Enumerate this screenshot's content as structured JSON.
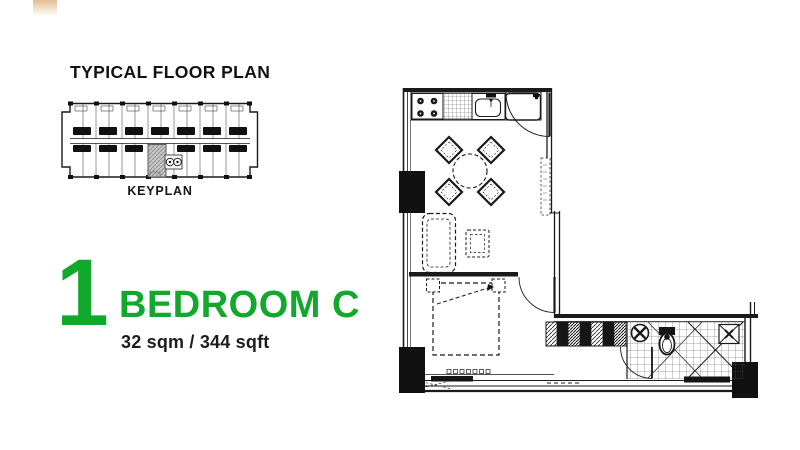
{
  "page": {
    "background": "#ffffff"
  },
  "decor": {
    "corner_square": {
      "top_color": "#e2bd92",
      "bottom_color": "#fdfaf5"
    }
  },
  "keyplan": {
    "title": "TYPICAL FLOOR PLAN",
    "caption": "KEYPLAN",
    "line_color": "#1a1a1a",
    "highlight_fill": "#c8c8c8"
  },
  "unit": {
    "big_number": "1",
    "name": "BEDROOM C",
    "area": "32 sqm / 344 sqft",
    "accent_color": "#12a82c",
    "text_color": "#1d1d1d"
  },
  "floorplan": {
    "line_color": "#1a1a1a"
  }
}
